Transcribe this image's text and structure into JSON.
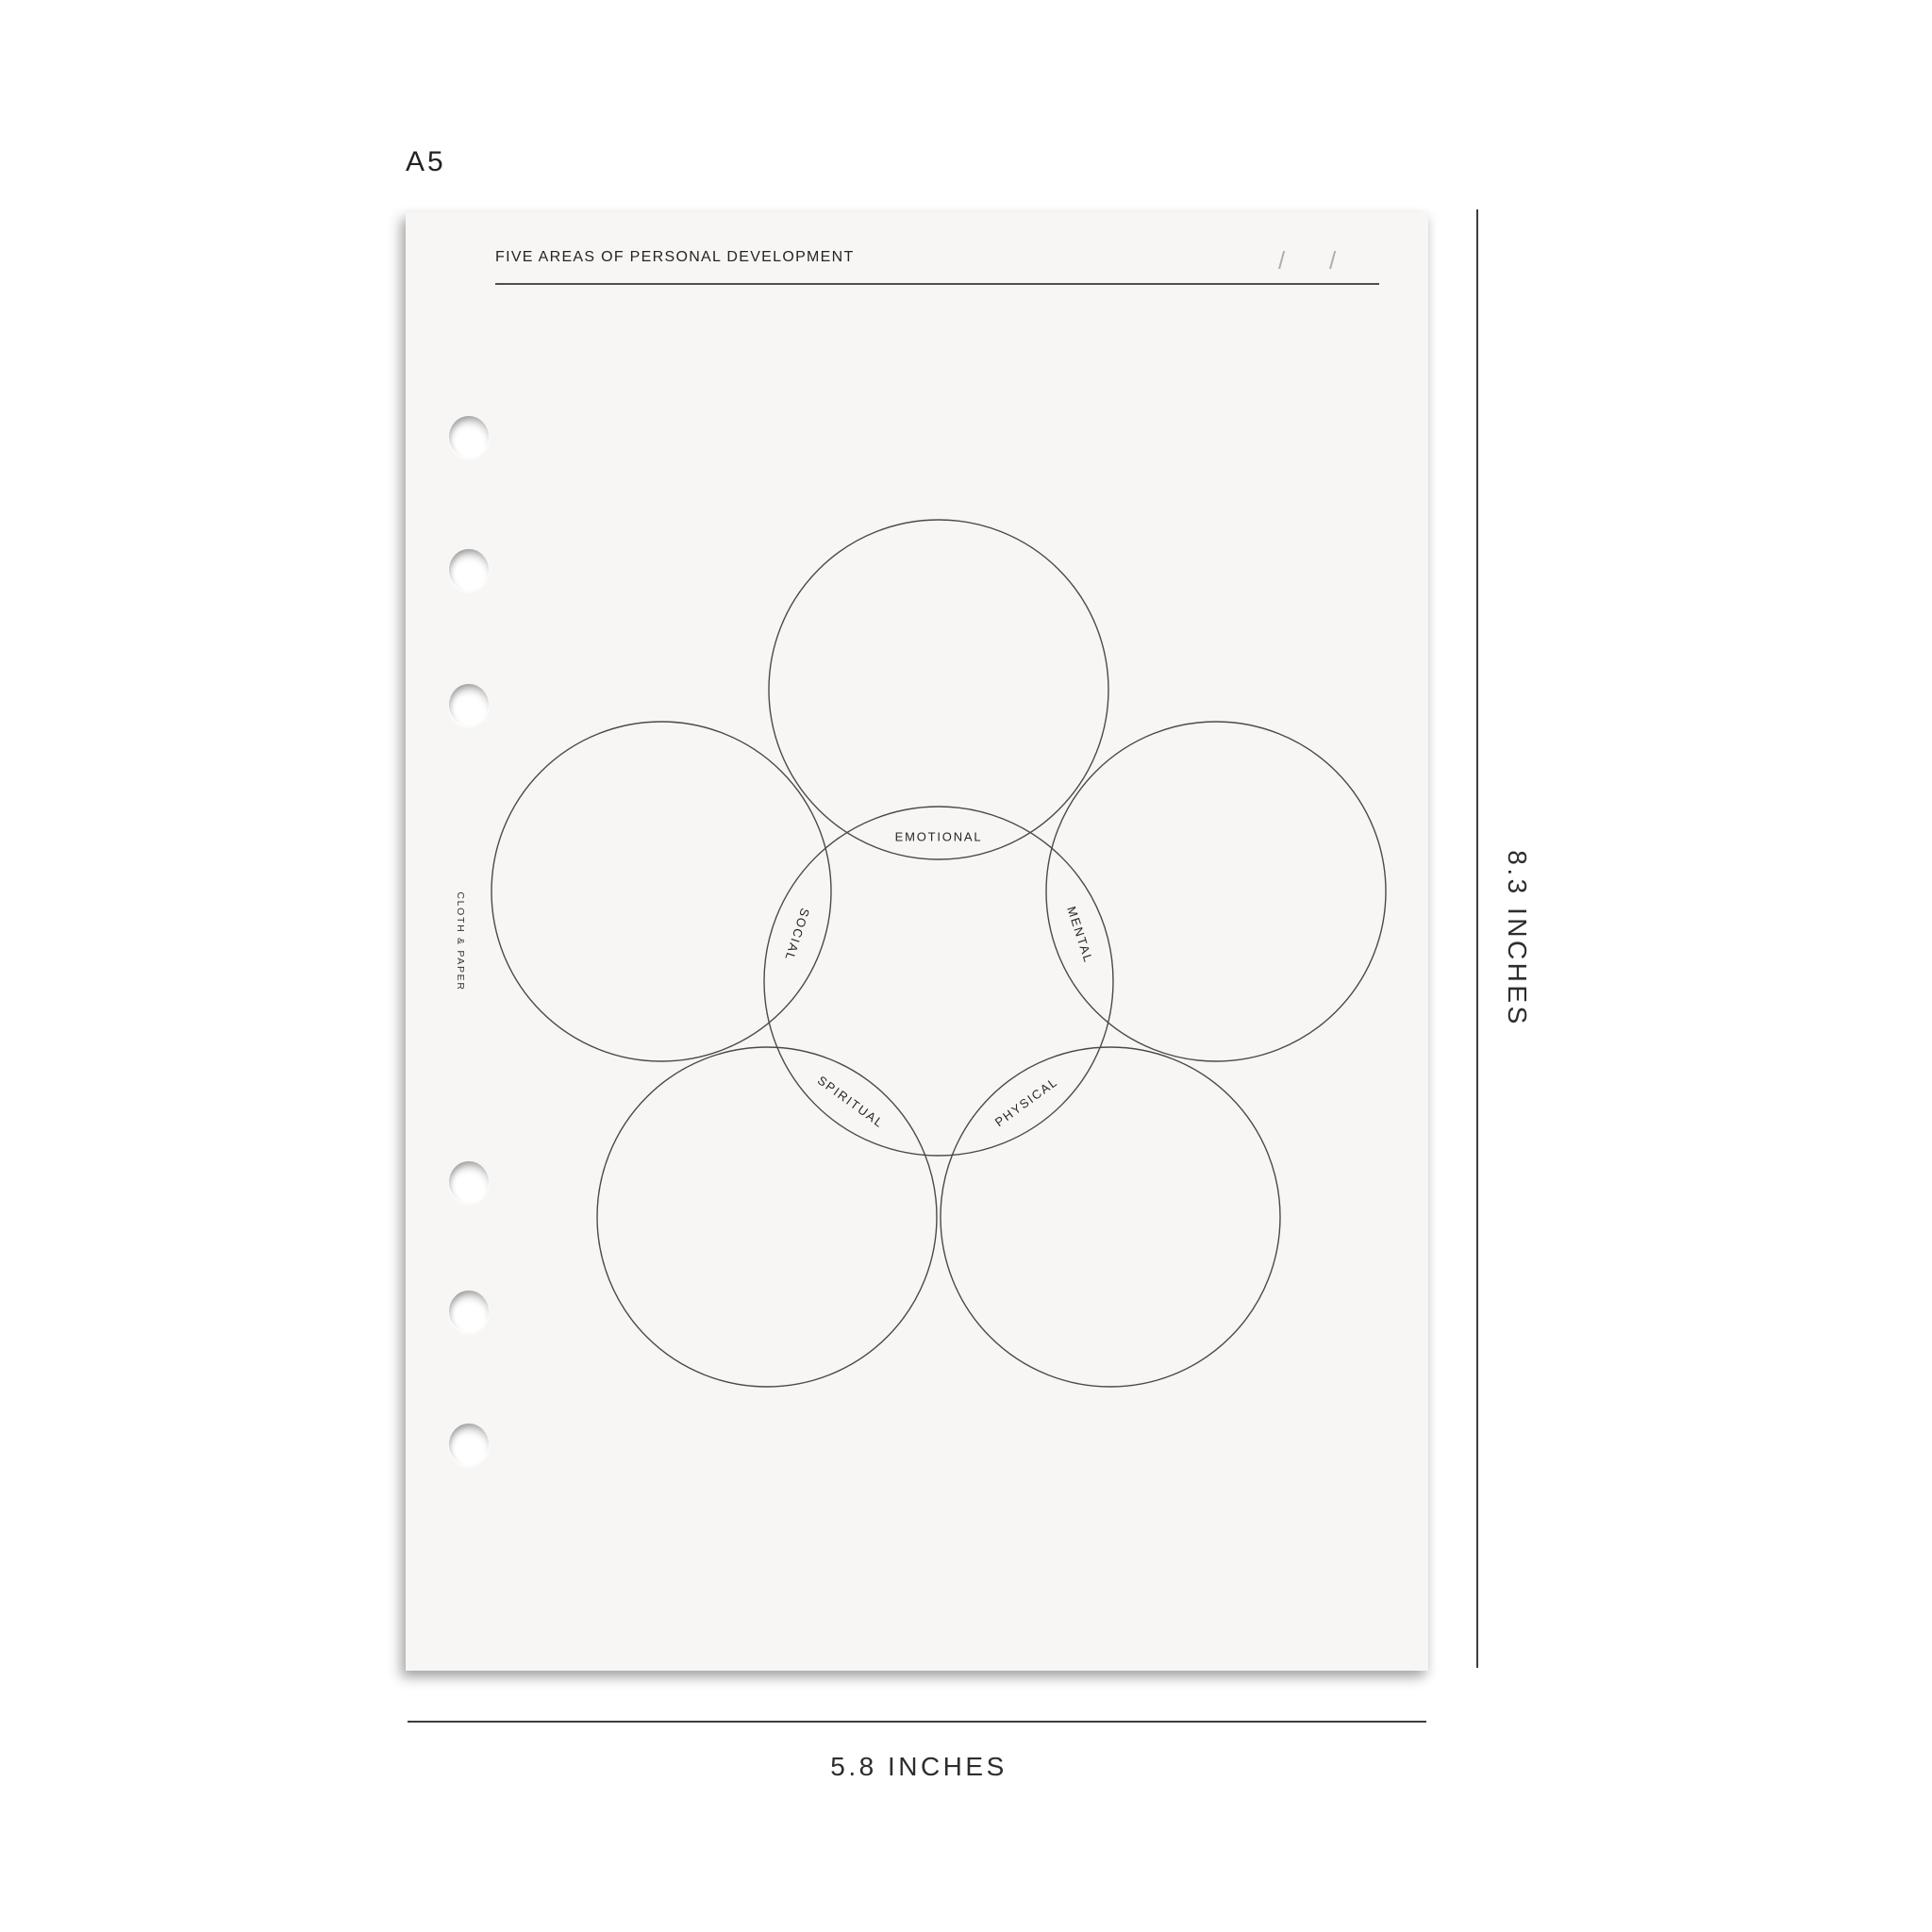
{
  "size_label": "A5",
  "page": {
    "title": "FIVE AREAS OF PERSONAL DEVELOPMENT",
    "date_slashes": [
      "/",
      "/"
    ],
    "brand_vertical": "CLOTH & PAPER"
  },
  "venn": {
    "labels": [
      "EMOTIONAL",
      "SOCIAL",
      "MENTAL",
      "SPIRITUAL",
      "PHYSICAL"
    ]
  },
  "dimensions": {
    "height_label": "8.3 INCHES",
    "width_label": "5.8 INCHES"
  },
  "colors": {
    "paper": "#f7f6f4",
    "ink": "#242424",
    "circle_stroke": "#4a4a4a",
    "ruler": "#3d3d3d",
    "slash": "#aeaeae"
  }
}
